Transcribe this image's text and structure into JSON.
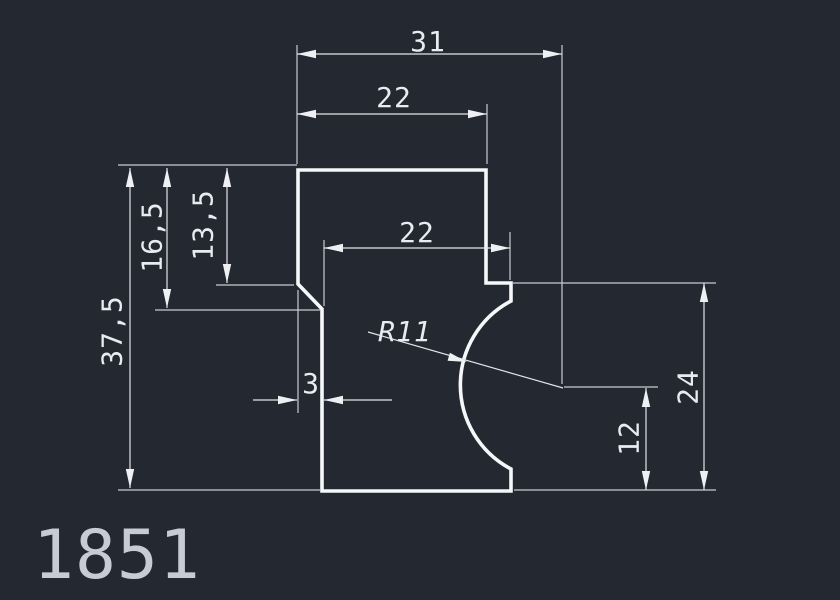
{
  "title": "CAD profile drawing",
  "part_number": "1851",
  "colors": {
    "background": "#232831",
    "profile_line": "#f5f7f9",
    "dimension_line": "#e2e6ea",
    "extension_line": "#c7ccd4",
    "dimension_text": "#e8ebef",
    "part_number_text": "#c6ccd3"
  },
  "dimensions": {
    "total_width": "31",
    "top_width": "22",
    "upper_left_depth": "16,5",
    "chamfer_start_depth": "13,5",
    "total_height": "37,5",
    "middle_width": "22",
    "chamfer_width": "3",
    "arc_radius": "R11",
    "arc_center_height": "12",
    "notch_step_height": "24"
  }
}
